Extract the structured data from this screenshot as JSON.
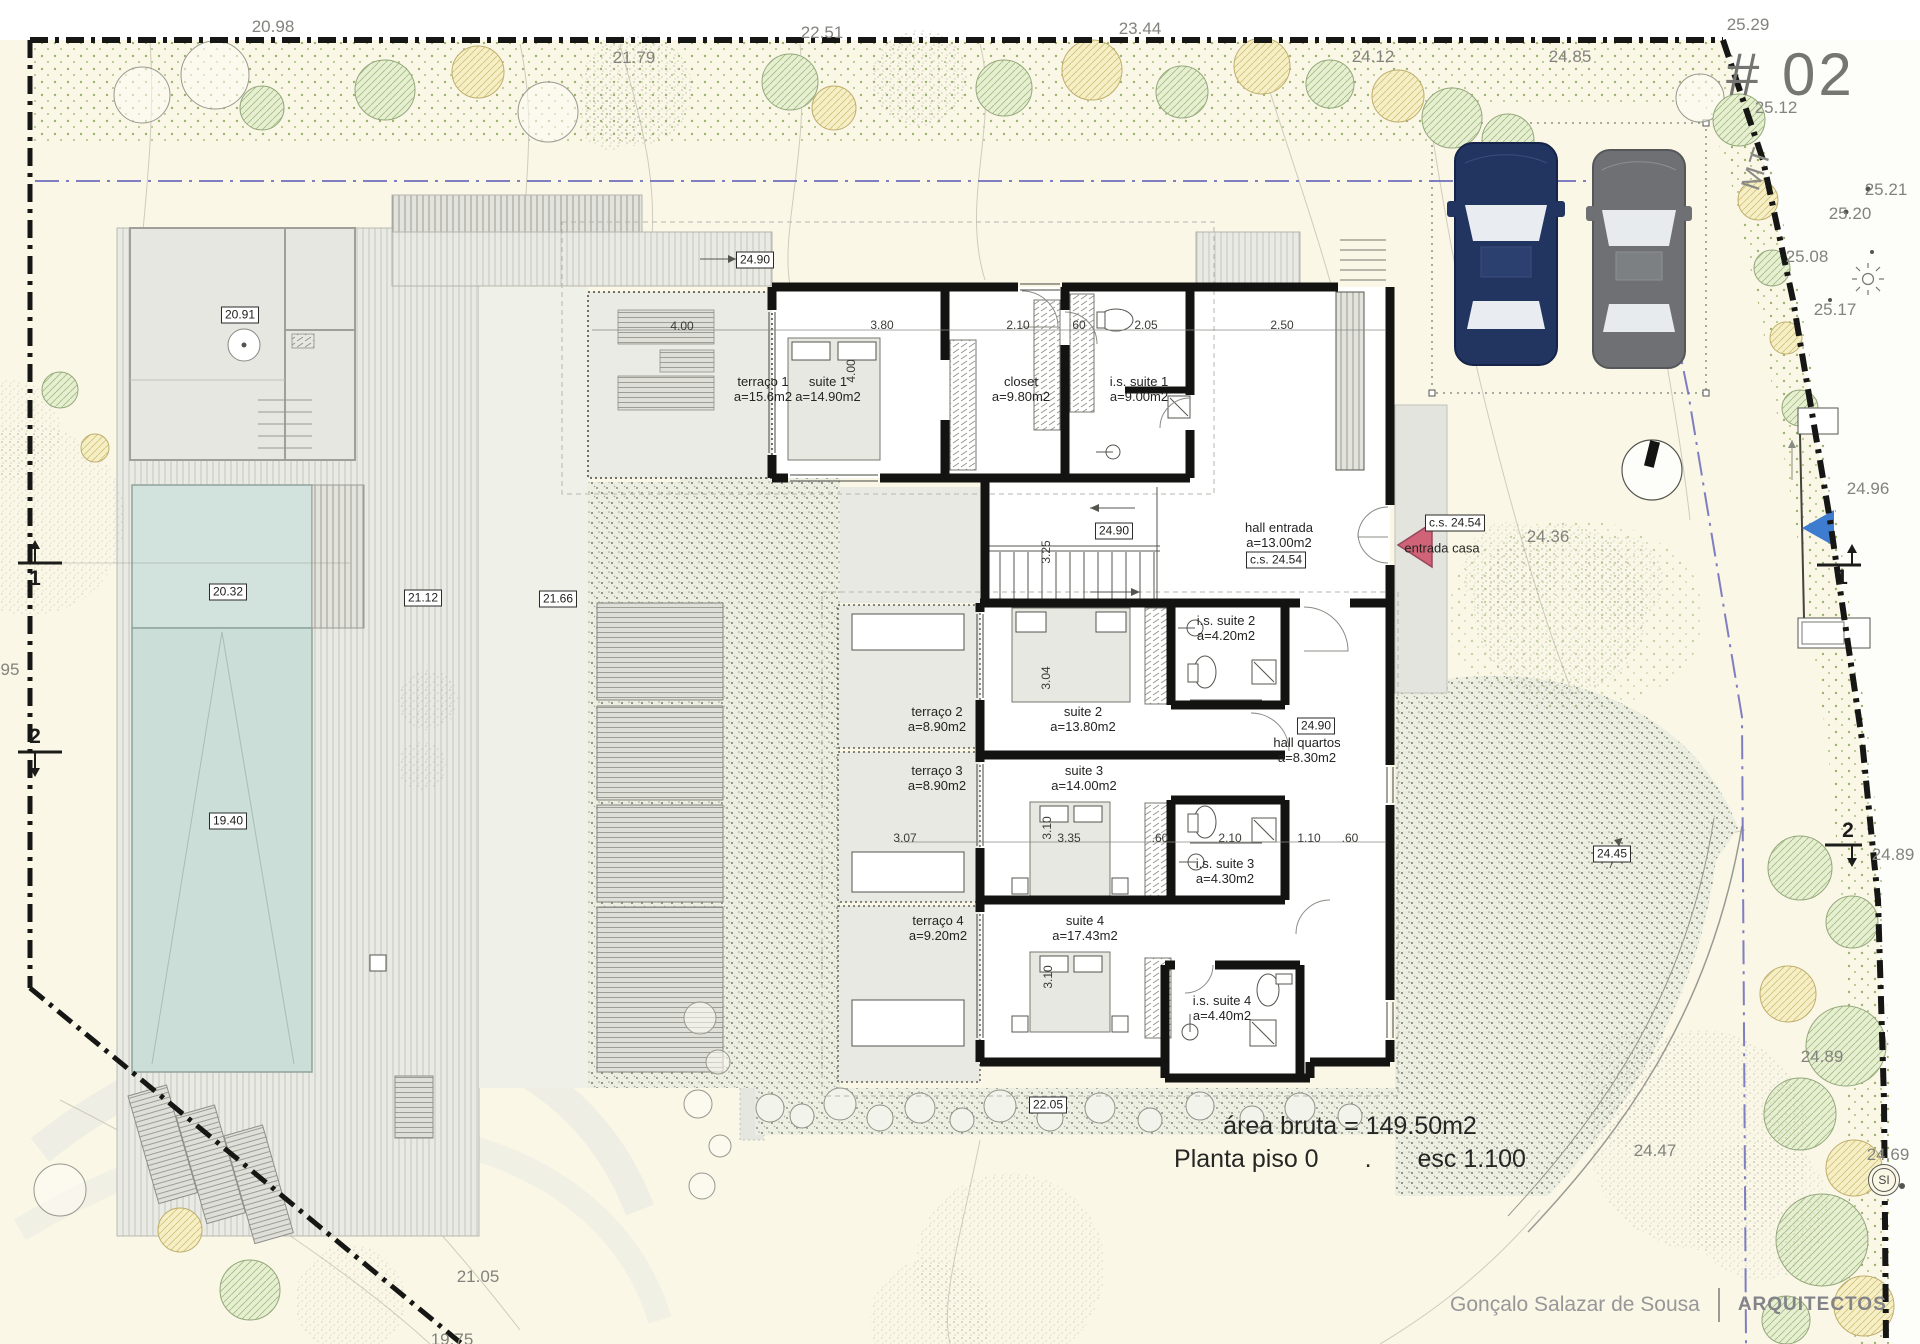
{
  "page": {
    "title": "# 02",
    "street": "MT"
  },
  "summary": {
    "area_bruta": "área bruta = 149.50m2",
    "plan_name": "Planta piso 0",
    "separator": ".",
    "scale": "esc 1.100"
  },
  "footer": {
    "architect": "Gonçalo Salazar de Sousa",
    "studio": "ARQUITECTOS"
  },
  "badges": {
    "survey": "SI"
  },
  "colors": {
    "site": "#faf7e6",
    "street": "#fdfdfa",
    "pool_shallow": "#d2e3dd",
    "pool_deep": "#cbdfd8",
    "wall": "#131311",
    "entry_arrow": "#d16379",
    "marker_blue": "#3e7cd0",
    "title_gray": "#757571",
    "car_navy": "#223560",
    "car_gray": "#6e7073"
  },
  "labels": [
    {
      "text": "20.98",
      "x": 273,
      "y": 27,
      "cls": "terrain"
    },
    {
      "text": "22.51",
      "x": 822,
      "y": 33,
      "cls": "terrain"
    },
    {
      "text": "23.44",
      "x": 1140,
      "y": 29,
      "cls": "terrain"
    },
    {
      "text": "21.79",
      "x": 634,
      "y": 58,
      "cls": "terrain"
    },
    {
      "text": "24.12",
      "x": 1373,
      "y": 57,
      "cls": "terrain"
    },
    {
      "text": "25.29",
      "x": 1748,
      "y": 25,
      "cls": "terrain"
    },
    {
      "text": "24.85",
      "x": 1570,
      "y": 57,
      "cls": "terrain"
    },
    {
      "text": "25.12",
      "x": 1776,
      "y": 108,
      "cls": "terrain"
    },
    {
      "text": "25.21",
      "x": 1886,
      "y": 190,
      "cls": "terrain"
    },
    {
      "text": "25.20",
      "x": 1850,
      "y": 214,
      "cls": "terrain"
    },
    {
      "text": "25.08",
      "x": 1807,
      "y": 257,
      "cls": "terrain"
    },
    {
      "text": "25.17",
      "x": 1835,
      "y": 310,
      "cls": "terrain"
    },
    {
      "text": "24.96",
      "x": 1868,
      "y": 489,
      "cls": "terrain"
    },
    {
      "text": "24.36",
      "x": 1548,
      "y": 537,
      "cls": "terrain"
    },
    {
      "text": "24.89",
      "x": 1893,
      "y": 855,
      "cls": "terrain"
    },
    {
      "text": "24.89",
      "x": 1822,
      "y": 1057,
      "cls": "terrain"
    },
    {
      "text": "24.47",
      "x": 1655,
      "y": 1151,
      "cls": "terrain"
    },
    {
      "text": "24.69",
      "x": 1888,
      "y": 1155,
      "cls": "terrain"
    },
    {
      "text": "21.05",
      "x": 478,
      "y": 1277,
      "cls": "terrain"
    },
    {
      "text": "19.75",
      "x": 452,
      "y": 1340,
      "cls": "terrain"
    },
    {
      "text": "95",
      "x": 10,
      "y": 670,
      "cls": "terrain"
    },
    {
      "text": "24.90",
      "x": 755,
      "y": 260,
      "cls": "elev"
    },
    {
      "text": "20.91",
      "x": 240,
      "y": 315,
      "cls": "elev"
    },
    {
      "text": "20.32",
      "x": 228,
      "y": 592,
      "cls": "elev"
    },
    {
      "text": "21.12",
      "x": 423,
      "y": 598,
      "cls": "elev"
    },
    {
      "text": "21.66",
      "x": 558,
      "y": 599,
      "cls": "elev"
    },
    {
      "text": "24.90",
      "x": 1114,
      "y": 531,
      "cls": "elev"
    },
    {
      "text": "c.s. 24.54",
      "x": 1276,
      "y": 560,
      "cls": "elev"
    },
    {
      "text": "c.s. 24.54",
      "x": 1455,
      "y": 523,
      "cls": "elev"
    },
    {
      "text": "24.90",
      "x": 1316,
      "y": 726,
      "cls": "elev"
    },
    {
      "text": "19.40",
      "x": 228,
      "y": 821,
      "cls": "elev"
    },
    {
      "text": "22.05",
      "x": 1048,
      "y": 1105,
      "cls": "elev"
    },
    {
      "text": "24.45",
      "x": 1612,
      "y": 854,
      "cls": "elev"
    },
    {
      "text": "4.00",
      "x": 682,
      "y": 326,
      "cls": "dim"
    },
    {
      "text": "3.80",
      "x": 882,
      "y": 325,
      "cls": "dim"
    },
    {
      "text": "2.10",
      "x": 1018,
      "y": 325,
      "cls": "dim"
    },
    {
      "text": "60",
      "x": 1079,
      "y": 325,
      "cls": "dim"
    },
    {
      "text": "2.05",
      "x": 1146,
      "y": 325,
      "cls": "dim"
    },
    {
      "text": "2.50",
      "x": 1282,
      "y": 325,
      "cls": "dim"
    },
    {
      "text": "4.00",
      "x": 851,
      "y": 371,
      "cls": "dim",
      "rot": -90
    },
    {
      "text": "3.25",
      "x": 1046,
      "y": 552,
      "cls": "dim",
      "rot": -90
    },
    {
      "text": "3.04",
      "x": 1046,
      "y": 678,
      "cls": "dim",
      "rot": -90
    },
    {
      "text": "3.07",
      "x": 905,
      "y": 838,
      "cls": "dim"
    },
    {
      "text": "3.35",
      "x": 1069,
      "y": 838,
      "cls": "dim"
    },
    {
      "text": "3.10",
      "x": 1047,
      "y": 828,
      "cls": "dim",
      "rot": -90
    },
    {
      "text": ".60",
      "x": 1160,
      "y": 838,
      "cls": "dim"
    },
    {
      "text": "2.10",
      "x": 1230,
      "y": 838,
      "cls": "dim"
    },
    {
      "text": "1.10",
      "x": 1309,
      "y": 838,
      "cls": "dim"
    },
    {
      "text": ".60",
      "x": 1350,
      "y": 838,
      "cls": "dim"
    },
    {
      "text": "3.10",
      "x": 1048,
      "y": 977,
      "cls": "dim",
      "rot": -90
    },
    {
      "text": "1",
      "x": 35,
      "y": 579,
      "cls": "sect"
    },
    {
      "text": "2",
      "x": 35,
      "y": 737,
      "cls": "sect"
    },
    {
      "text": "1",
      "x": 1842,
      "y": 578,
      "cls": "sect"
    },
    {
      "text": "2",
      "x": 1848,
      "y": 831,
      "cls": "sect"
    },
    {
      "text": "MT",
      "x": 1757,
      "y": 168,
      "cls": "mt",
      "rot": -72
    }
  ],
  "rooms": [
    {
      "name": "terraço 1",
      "area": "a=15.6m2",
      "x": 763,
      "y": 389
    },
    {
      "name": "suite 1",
      "area": "a=14.90m2",
      "x": 828,
      "y": 389
    },
    {
      "name": "closet",
      "area": "a=9.80m2",
      "x": 1021,
      "y": 389
    },
    {
      "name": "i.s. suite 1",
      "area": "a=9.00m2",
      "x": 1139,
      "y": 389
    },
    {
      "name": "hall entrada",
      "area": "a=13.00m2",
      "x": 1279,
      "y": 535
    },
    {
      "name": "i.s. suite 2",
      "area": "a=4.20m2",
      "x": 1226,
      "y": 628
    },
    {
      "name": "terraço 2",
      "area": "a=8.90m2",
      "x": 937,
      "y": 719
    },
    {
      "name": "suite 2",
      "area": "a=13.80m2",
      "x": 1083,
      "y": 719
    },
    {
      "name": "hall quartos",
      "area": "a=8.30m2",
      "x": 1307,
      "y": 750
    },
    {
      "name": "terraço 3",
      "area": "a=8.90m2",
      "x": 937,
      "y": 778
    },
    {
      "name": "suite 3",
      "area": "a=14.00m2",
      "x": 1084,
      "y": 778
    },
    {
      "name": "i.s. suite 3",
      "area": "a=4.30m2",
      "x": 1225,
      "y": 871
    },
    {
      "name": "terraço 4",
      "area": "a=9.20m2",
      "x": 938,
      "y": 928
    },
    {
      "name": "suite 4",
      "area": "a=17.43m2",
      "x": 1085,
      "y": 928
    },
    {
      "name": "i.s. suite 4",
      "area": "a=4.40m2",
      "x": 1222,
      "y": 1008
    },
    {
      "name": "entrada casa",
      "area": "",
      "x": 1442,
      "y": 548
    }
  ]
}
